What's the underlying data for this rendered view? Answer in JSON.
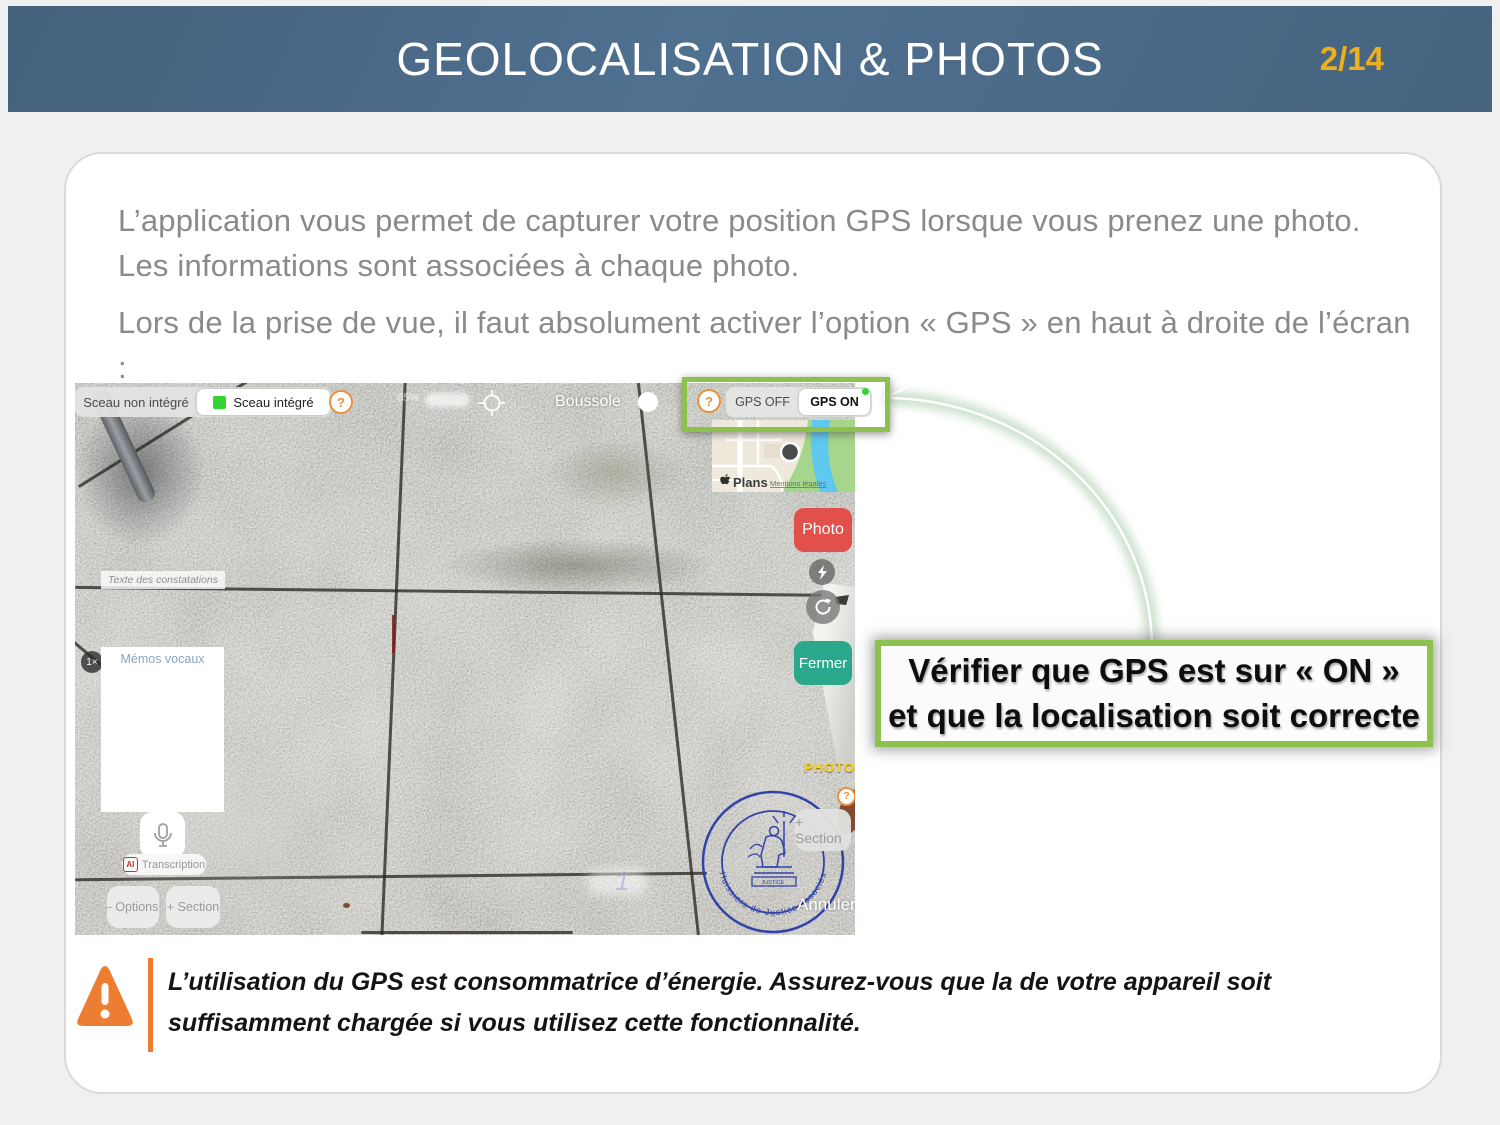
{
  "header": {
    "title": "GEOLOCALISATION & PHOTOS",
    "page": "2/14"
  },
  "intro": {
    "p1": "L’application vous permet de capturer votre position GPS lorsque vous prenez une photo. Les informations sont associées à chaque photo.",
    "p2": "Lors de la prise de vue, il faut absolument activer l’option « GPS » en haut à droite de l’écran :"
  },
  "screenshot": {
    "seal_toggle": {
      "off": "Sceau non intégré",
      "on": "Sceau intégré"
    },
    "help": "?",
    "blurred_info": "85%",
    "compass": "Boussole",
    "gps": {
      "off": "GPS OFF",
      "on": "GPS ON"
    },
    "map": {
      "brand": "Plans",
      "legal": "Mentions légales"
    },
    "photo_btn": "Photo",
    "fermer_btn": "Fermer",
    "constat_placeholder": "Texte des constatations",
    "zoom_badge": "1×",
    "memos_title": "Mémos vocaux",
    "ai": "AI",
    "transcription": "Transcription",
    "options_btn": "- Options",
    "section_btn_left": "+ Section",
    "section_btn_right": "+ Section",
    "photo_mode": "PHOTO",
    "annuler": "Annuler",
    "seal_text": "Huissiers de Justice Associés",
    "seal_banner": "JUSTICE"
  },
  "callout": {
    "line1": "Vérifier que GPS est sur « ON »",
    "line2": "et que la localisation soit correcte"
  },
  "warning": {
    "line1": "L’utilisation du GPS est consommatrice d’énergie. Assurez-vous que la de votre appareil soit",
    "line2": "suffisamment chargée si vous utilisez cette fonctionnalité."
  },
  "colors": {
    "accent_green": "#8cc04f",
    "header_blue": "#4d6c89",
    "warning_orange": "#ed7d31",
    "page_gold": "#edaf1d"
  }
}
